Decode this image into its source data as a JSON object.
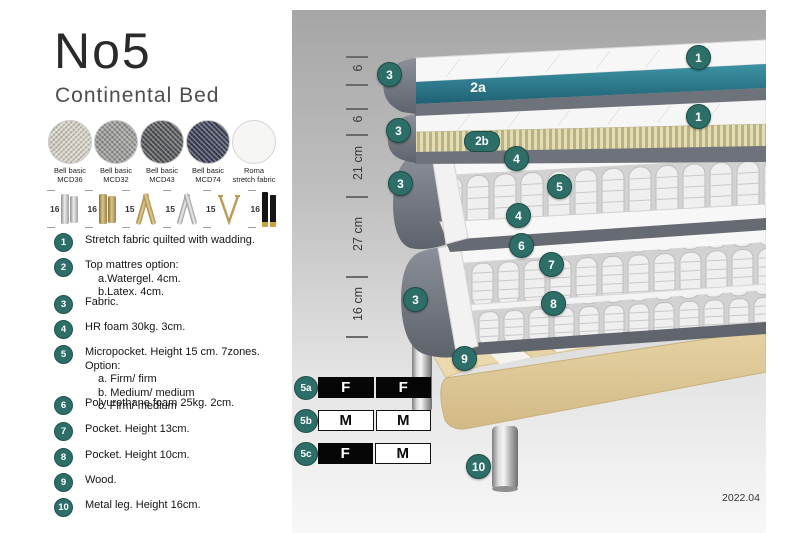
{
  "header": {
    "title": "No5",
    "subtitle": "Continental Bed"
  },
  "colors": {
    "accent_teal": "#2d6e68",
    "watergel_teal": "#2e7f92",
    "latex_cream": "#ddd6ad",
    "shell_gray": "#73787f",
    "wood": "#ecd9ae",
    "panel_top_gray": "#a6a6a6",
    "panel_bottom_gray": "#f7f7f7"
  },
  "fabric_swatches": [
    {
      "line1": "Bell basic",
      "line2": "MCD36",
      "color": "#d9d4c8"
    },
    {
      "line1": "Bell basic",
      "line2": "MCD32",
      "color": "#9b9b99"
    },
    {
      "line1": "Bell basic",
      "line2": "MCD43",
      "color": "#55565a"
    },
    {
      "line1": "Bell basic",
      "line2": "MCD74",
      "color": "#3c4157"
    },
    {
      "line1": "Roma",
      "line2": "stretch fabric",
      "color": "#f6f6f5"
    }
  ],
  "leg_options": [
    {
      "height": "16",
      "style": "cylinder-silver"
    },
    {
      "height": "16",
      "style": "cylinder-brass"
    },
    {
      "height": "15",
      "style": "twist-gold"
    },
    {
      "height": "15",
      "style": "twist-silver"
    },
    {
      "height": "15",
      "style": "hairpin-brass"
    },
    {
      "height": "16",
      "style": "block-black-gold"
    }
  ],
  "legend": {
    "items": [
      {
        "num": "1",
        "text": "Stretch fabric quilted with wadding."
      },
      {
        "num": "2",
        "text": "Top mattres option:",
        "subs": [
          "a.Watergel. 4cm.",
          "b.Latex. 4cm."
        ]
      },
      {
        "num": "3",
        "text": "Fabric."
      },
      {
        "num": "4",
        "text": "HR foam 30kg. 3cm."
      },
      {
        "num": "5",
        "text": "Micropocket. Height 15 cm. 7zones. Option:",
        "subs": [
          "a. Firm/ firm",
          "b. Medium/ medium",
          "c. Firm/ medium"
        ]
      },
      {
        "num": "6",
        "text": "Polyurethane foam 25kg. 2cm."
      },
      {
        "num": "7",
        "text": "Pocket. Height 13cm."
      },
      {
        "num": "8",
        "text": "Pocket. Height 10cm."
      },
      {
        "num": "9",
        "text": "Wood."
      },
      {
        "num": "10",
        "text": "Metal leg. Height 16cm."
      }
    ]
  },
  "diagram": {
    "measurements": [
      {
        "label": "6"
      },
      {
        "label": "6"
      },
      {
        "label": "21 cm"
      },
      {
        "label": "27 cm"
      },
      {
        "label": "16 cm"
      }
    ],
    "callouts": {
      "n1": "1",
      "n2a": "2a",
      "n2b": "2b",
      "n3": "3",
      "n4": "4",
      "n5": "5",
      "n6": "6",
      "n7": "7",
      "n8": "8",
      "n9": "9",
      "n10": "10"
    },
    "firmness": {
      "rows": [
        {
          "id": "5a",
          "cells": [
            {
              "label": "F",
              "variant": "dark"
            },
            {
              "label": "F",
              "variant": "dark"
            }
          ]
        },
        {
          "id": "5b",
          "cells": [
            {
              "label": "M",
              "variant": "light"
            },
            {
              "label": "M",
              "variant": "light"
            }
          ]
        },
        {
          "id": "5c",
          "cells": [
            {
              "label": "F",
              "variant": "dark"
            },
            {
              "label": "M",
              "variant": "light"
            }
          ]
        }
      ]
    },
    "version": "2022.04"
  }
}
